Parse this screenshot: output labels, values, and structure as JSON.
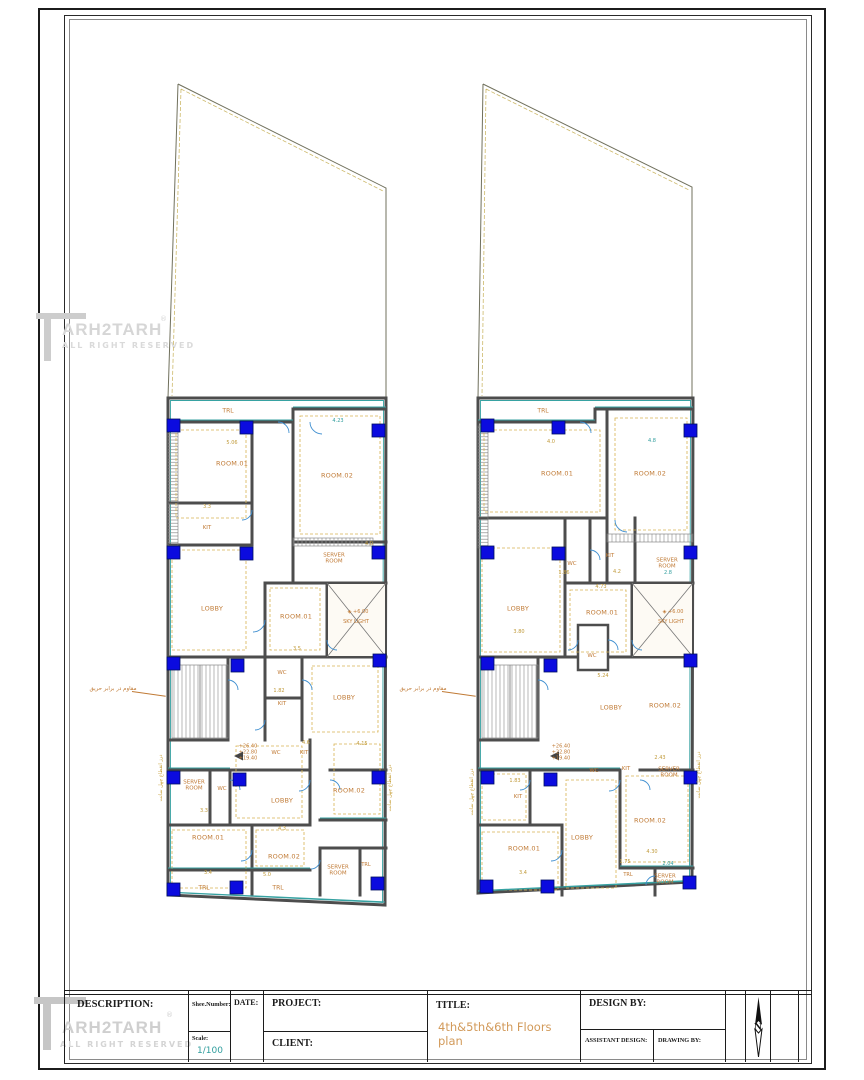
{
  "title_block": {
    "description": "DESCRIPTION:",
    "sheet_number": "Shee.Number:",
    "date": "DATE:",
    "project": "PROJECT:",
    "client": "CLIENT:",
    "title": "TITLE:",
    "title_value": "4th&5th&6th Floors plan",
    "design_by": "DESIGN BY:",
    "assistant_design": "ASSISTANT  DESIGN:",
    "drawing_by": "DRAWING BY:",
    "scale": "Scale:",
    "scale_value": "1/100",
    "north": "N"
  },
  "watermark": {
    "brand": "ARH2TARH",
    "reg": "®",
    "tagline": "ALL RIGHT RESERVED"
  },
  "colors": {
    "wall": "#4d4d4d",
    "teal_accent": "#37a2a2",
    "column_blue": "#0b0bdf",
    "label_orange": "#c07a35",
    "dashed_orange": "#d8b351",
    "title_orange": "#d29a5a",
    "scale_teal": "#2f9d9d"
  },
  "labels": [
    {
      "t": "TRL",
      "x": 228,
      "y": 412,
      "c": "tr",
      "n": "room-label-trl"
    },
    {
      "t": "ROOM.01",
      "x": 232,
      "y": 464,
      "c": "room",
      "n": "room-label"
    },
    {
      "t": "ROOM.02",
      "x": 337,
      "y": 476,
      "c": "room",
      "n": "room-label"
    },
    {
      "t": "KIT",
      "x": 207,
      "y": 528,
      "c": "rs",
      "n": "room-label"
    },
    {
      "t": "SERVER\nROOM",
      "x": 334,
      "y": 559,
      "c": "rs",
      "n": "room-label"
    },
    {
      "t": "LOBBY",
      "x": 212,
      "y": 609,
      "c": "room",
      "n": "room-label"
    },
    {
      "t": "ROOM.01",
      "x": 296,
      "y": 617,
      "c": "room",
      "n": "room-label"
    },
    {
      "t": "◈ +6.00",
      "x": 358,
      "y": 613,
      "c": "sky",
      "n": "skylight-level"
    },
    {
      "t": "SKY LIGHT",
      "x": 356,
      "y": 623,
      "c": "sky",
      "n": "room-label"
    },
    {
      "t": "WC",
      "x": 282,
      "y": 673,
      "c": "rs",
      "n": "room-label"
    },
    {
      "t": "KIT",
      "x": 282,
      "y": 704,
      "c": "rs",
      "n": "room-label"
    },
    {
      "t": "LOBBY",
      "x": 344,
      "y": 698,
      "c": "room",
      "n": "room-label"
    },
    {
      "t": "+26.40\n+22.80\n+19.40",
      "x": 248,
      "y": 753,
      "c": "lvl",
      "n": "level-annotation"
    },
    {
      "t": "WC",
      "x": 276,
      "y": 753,
      "c": "rs",
      "n": "room-label"
    },
    {
      "t": "KIT",
      "x": 304,
      "y": 753,
      "c": "rs",
      "n": "room-label"
    },
    {
      "t": "SERVER\nROOM",
      "x": 194,
      "y": 786,
      "c": "rs",
      "n": "room-label"
    },
    {
      "t": "WC",
      "x": 222,
      "y": 789,
      "c": "rs",
      "n": "room-label"
    },
    {
      "t": "LOBBY",
      "x": 282,
      "y": 801,
      "c": "room",
      "n": "room-label"
    },
    {
      "t": "ROOM.02",
      "x": 349,
      "y": 791,
      "c": "room",
      "n": "room-label"
    },
    {
      "t": "ROOM.01",
      "x": 208,
      "y": 838,
      "c": "room",
      "n": "room-label"
    },
    {
      "t": "ROOM.02",
      "x": 284,
      "y": 857,
      "c": "room",
      "n": "room-label"
    },
    {
      "t": "SERVER\nROOM",
      "x": 338,
      "y": 871,
      "c": "rs",
      "n": "room-label"
    },
    {
      "t": "TRL",
      "x": 366,
      "y": 866,
      "c": "trs",
      "n": "room-label-trl"
    },
    {
      "t": "TRL",
      "x": 204,
      "y": 889,
      "c": "tr",
      "n": "room-label-trl"
    },
    {
      "t": "TRL",
      "x": 278,
      "y": 889,
      "c": "tr",
      "n": "room-label-trl"
    },
    {
      "t": "مقاوم در برابر حریق",
      "x": 113,
      "y": 689,
      "c": "fa",
      "n": "fire-resistant-note"
    },
    {
      "t": "درز انقطاع چهل سانت",
      "x": 162,
      "y": 778,
      "c": "fav",
      "r": -90,
      "n": "expansion-joint-note"
    },
    {
      "t": "درز انقطاع چهل سانت",
      "x": 391,
      "y": 788,
      "c": "fav",
      "r": -90,
      "n": "expansion-joint-note"
    },
    {
      "t": "5.06",
      "x": 232,
      "y": 444,
      "c": "dim",
      "n": "dimension"
    },
    {
      "t": "4.23",
      "x": 338,
      "y": 422,
      "c": "dimt",
      "n": "dimension"
    },
    {
      "t": "3.3",
      "x": 207,
      "y": 508,
      "c": "dim",
      "n": "dimension"
    },
    {
      "t": "4.0",
      "x": 369,
      "y": 545,
      "c": "dim",
      "n": "dimension"
    },
    {
      "t": "3.5",
      "x": 297,
      "y": 650,
      "c": "dim",
      "n": "dimension"
    },
    {
      "t": "1.82",
      "x": 279,
      "y": 692,
      "c": "dim",
      "n": "dimension"
    },
    {
      "t": "4.6",
      "x": 306,
      "y": 744,
      "c": "dim",
      "n": "dimension"
    },
    {
      "t": "4.15",
      "x": 362,
      "y": 745,
      "c": "dim",
      "n": "dimension"
    },
    {
      "t": "3.3",
      "x": 204,
      "y": 812,
      "c": "dim",
      "n": "dimension"
    },
    {
      "t": "4.3",
      "x": 282,
      "y": 830,
      "c": "dim",
      "n": "dimension"
    },
    {
      "t": "3.4",
      "x": 208,
      "y": 874,
      "c": "dim",
      "n": "dimension"
    },
    {
      "t": "5.0",
      "x": 267,
      "y": 876,
      "c": "dim",
      "n": "dimension"
    },
    {
      "t": "TRL",
      "x": 543,
      "y": 412,
      "c": "tr",
      "n": "room-label-trl"
    },
    {
      "t": "ROOM.01",
      "x": 557,
      "y": 474,
      "c": "room",
      "n": "room-label"
    },
    {
      "t": "ROOM.02",
      "x": 650,
      "y": 474,
      "c": "room",
      "n": "room-label"
    },
    {
      "t": "WC",
      "x": 572,
      "y": 564,
      "c": "rs",
      "n": "room-label"
    },
    {
      "t": "KIT",
      "x": 610,
      "y": 556,
      "c": "rs",
      "n": "room-label"
    },
    {
      "t": "SERVER\nROOM",
      "x": 667,
      "y": 564,
      "c": "rs",
      "n": "room-label"
    },
    {
      "t": "LOBBY",
      "x": 518,
      "y": 609,
      "c": "room",
      "n": "room-label"
    },
    {
      "t": "ROOM.01",
      "x": 602,
      "y": 613,
      "c": "room",
      "n": "room-label"
    },
    {
      "t": "◈ +6.00",
      "x": 673,
      "y": 613,
      "c": "sky",
      "n": "skylight-level"
    },
    {
      "t": "SKY LIGHT",
      "x": 671,
      "y": 623,
      "c": "sky",
      "n": "room-label"
    },
    {
      "t": "WC",
      "x": 592,
      "y": 656,
      "c": "rs",
      "n": "room-label"
    },
    {
      "t": "LOBBY",
      "x": 611,
      "y": 708,
      "c": "room",
      "n": "room-label"
    },
    {
      "t": "ROOM.02",
      "x": 665,
      "y": 706,
      "c": "room",
      "n": "room-label"
    },
    {
      "t": "مقاوم در برابر حریق",
      "x": 423,
      "y": 689,
      "c": "fa",
      "n": "fire-resistant-note"
    },
    {
      "t": "+26.40\n+22.80\n+19.40",
      "x": 561,
      "y": 753,
      "c": "lvl",
      "n": "level-annotation"
    },
    {
      "t": "WC",
      "x": 594,
      "y": 771,
      "c": "rs",
      "n": "room-label"
    },
    {
      "t": "KIT",
      "x": 626,
      "y": 769,
      "c": "rs",
      "n": "room-label"
    },
    {
      "t": "SERVER\nROOM",
      "x": 669,
      "y": 773,
      "c": "rs",
      "n": "room-label"
    },
    {
      "t": "KIT",
      "x": 518,
      "y": 797,
      "c": "rs",
      "n": "room-label"
    },
    {
      "t": "ROOM.02",
      "x": 650,
      "y": 821,
      "c": "room",
      "n": "room-label"
    },
    {
      "t": "LOBBY",
      "x": 582,
      "y": 838,
      "c": "room",
      "n": "room-label"
    },
    {
      "t": "ROOM.01",
      "x": 524,
      "y": 849,
      "c": "room",
      "n": "room-label"
    },
    {
      "t": "TRL",
      "x": 628,
      "y": 876,
      "c": "trs",
      "n": "room-label-trl"
    },
    {
      "t": "SERVER\nROOM",
      "x": 665,
      "y": 880,
      "c": "rs",
      "n": "room-label"
    },
    {
      "t": "درز انقطاع چهل سانت",
      "x": 700,
      "y": 775,
      "c": "fav",
      "r": -90,
      "n": "expansion-joint-note"
    },
    {
      "t": "درز انقطاع چهل سانت",
      "x": 473,
      "y": 792,
      "c": "fav",
      "r": -90,
      "n": "expansion-joint-note"
    },
    {
      "t": "4.0",
      "x": 551,
      "y": 443,
      "c": "dim",
      "n": "dimension"
    },
    {
      "t": "4.8",
      "x": 652,
      "y": 442,
      "c": "dimt",
      "n": "dimension"
    },
    {
      "t": "1.86",
      "x": 564,
      "y": 574,
      "c": "dim",
      "n": "dimension"
    },
    {
      "t": "4.2",
      "x": 617,
      "y": 573,
      "c": "dim",
      "n": "dimension"
    },
    {
      "t": "2.8",
      "x": 668,
      "y": 574,
      "c": "dimt",
      "n": "dimension"
    },
    {
      "t": "4.73",
      "x": 601,
      "y": 588,
      "c": "dim",
      "n": "dimension"
    },
    {
      "t": "3.80",
      "x": 519,
      "y": 633,
      "c": "dim",
      "n": "dimension"
    },
    {
      "t": "5.24",
      "x": 603,
      "y": 677,
      "c": "dim",
      "n": "dimension"
    },
    {
      "t": "2.43",
      "x": 660,
      "y": 759,
      "c": "dim",
      "n": "dimension"
    },
    {
      "t": "1.83",
      "x": 515,
      "y": 782,
      "c": "dim",
      "n": "dimension"
    },
    {
      "t": "4.30",
      "x": 652,
      "y": 853,
      "c": "dim",
      "n": "dimension"
    },
    {
      "t": "1.75",
      "x": 625,
      "y": 863,
      "c": "dim",
      "n": "dimension"
    },
    {
      "t": "2.04",
      "x": 668,
      "y": 865,
      "c": "dimt",
      "n": "dimension"
    },
    {
      "t": "3.4",
      "x": 523,
      "y": 874,
      "c": "dim",
      "n": "dimension"
    }
  ]
}
